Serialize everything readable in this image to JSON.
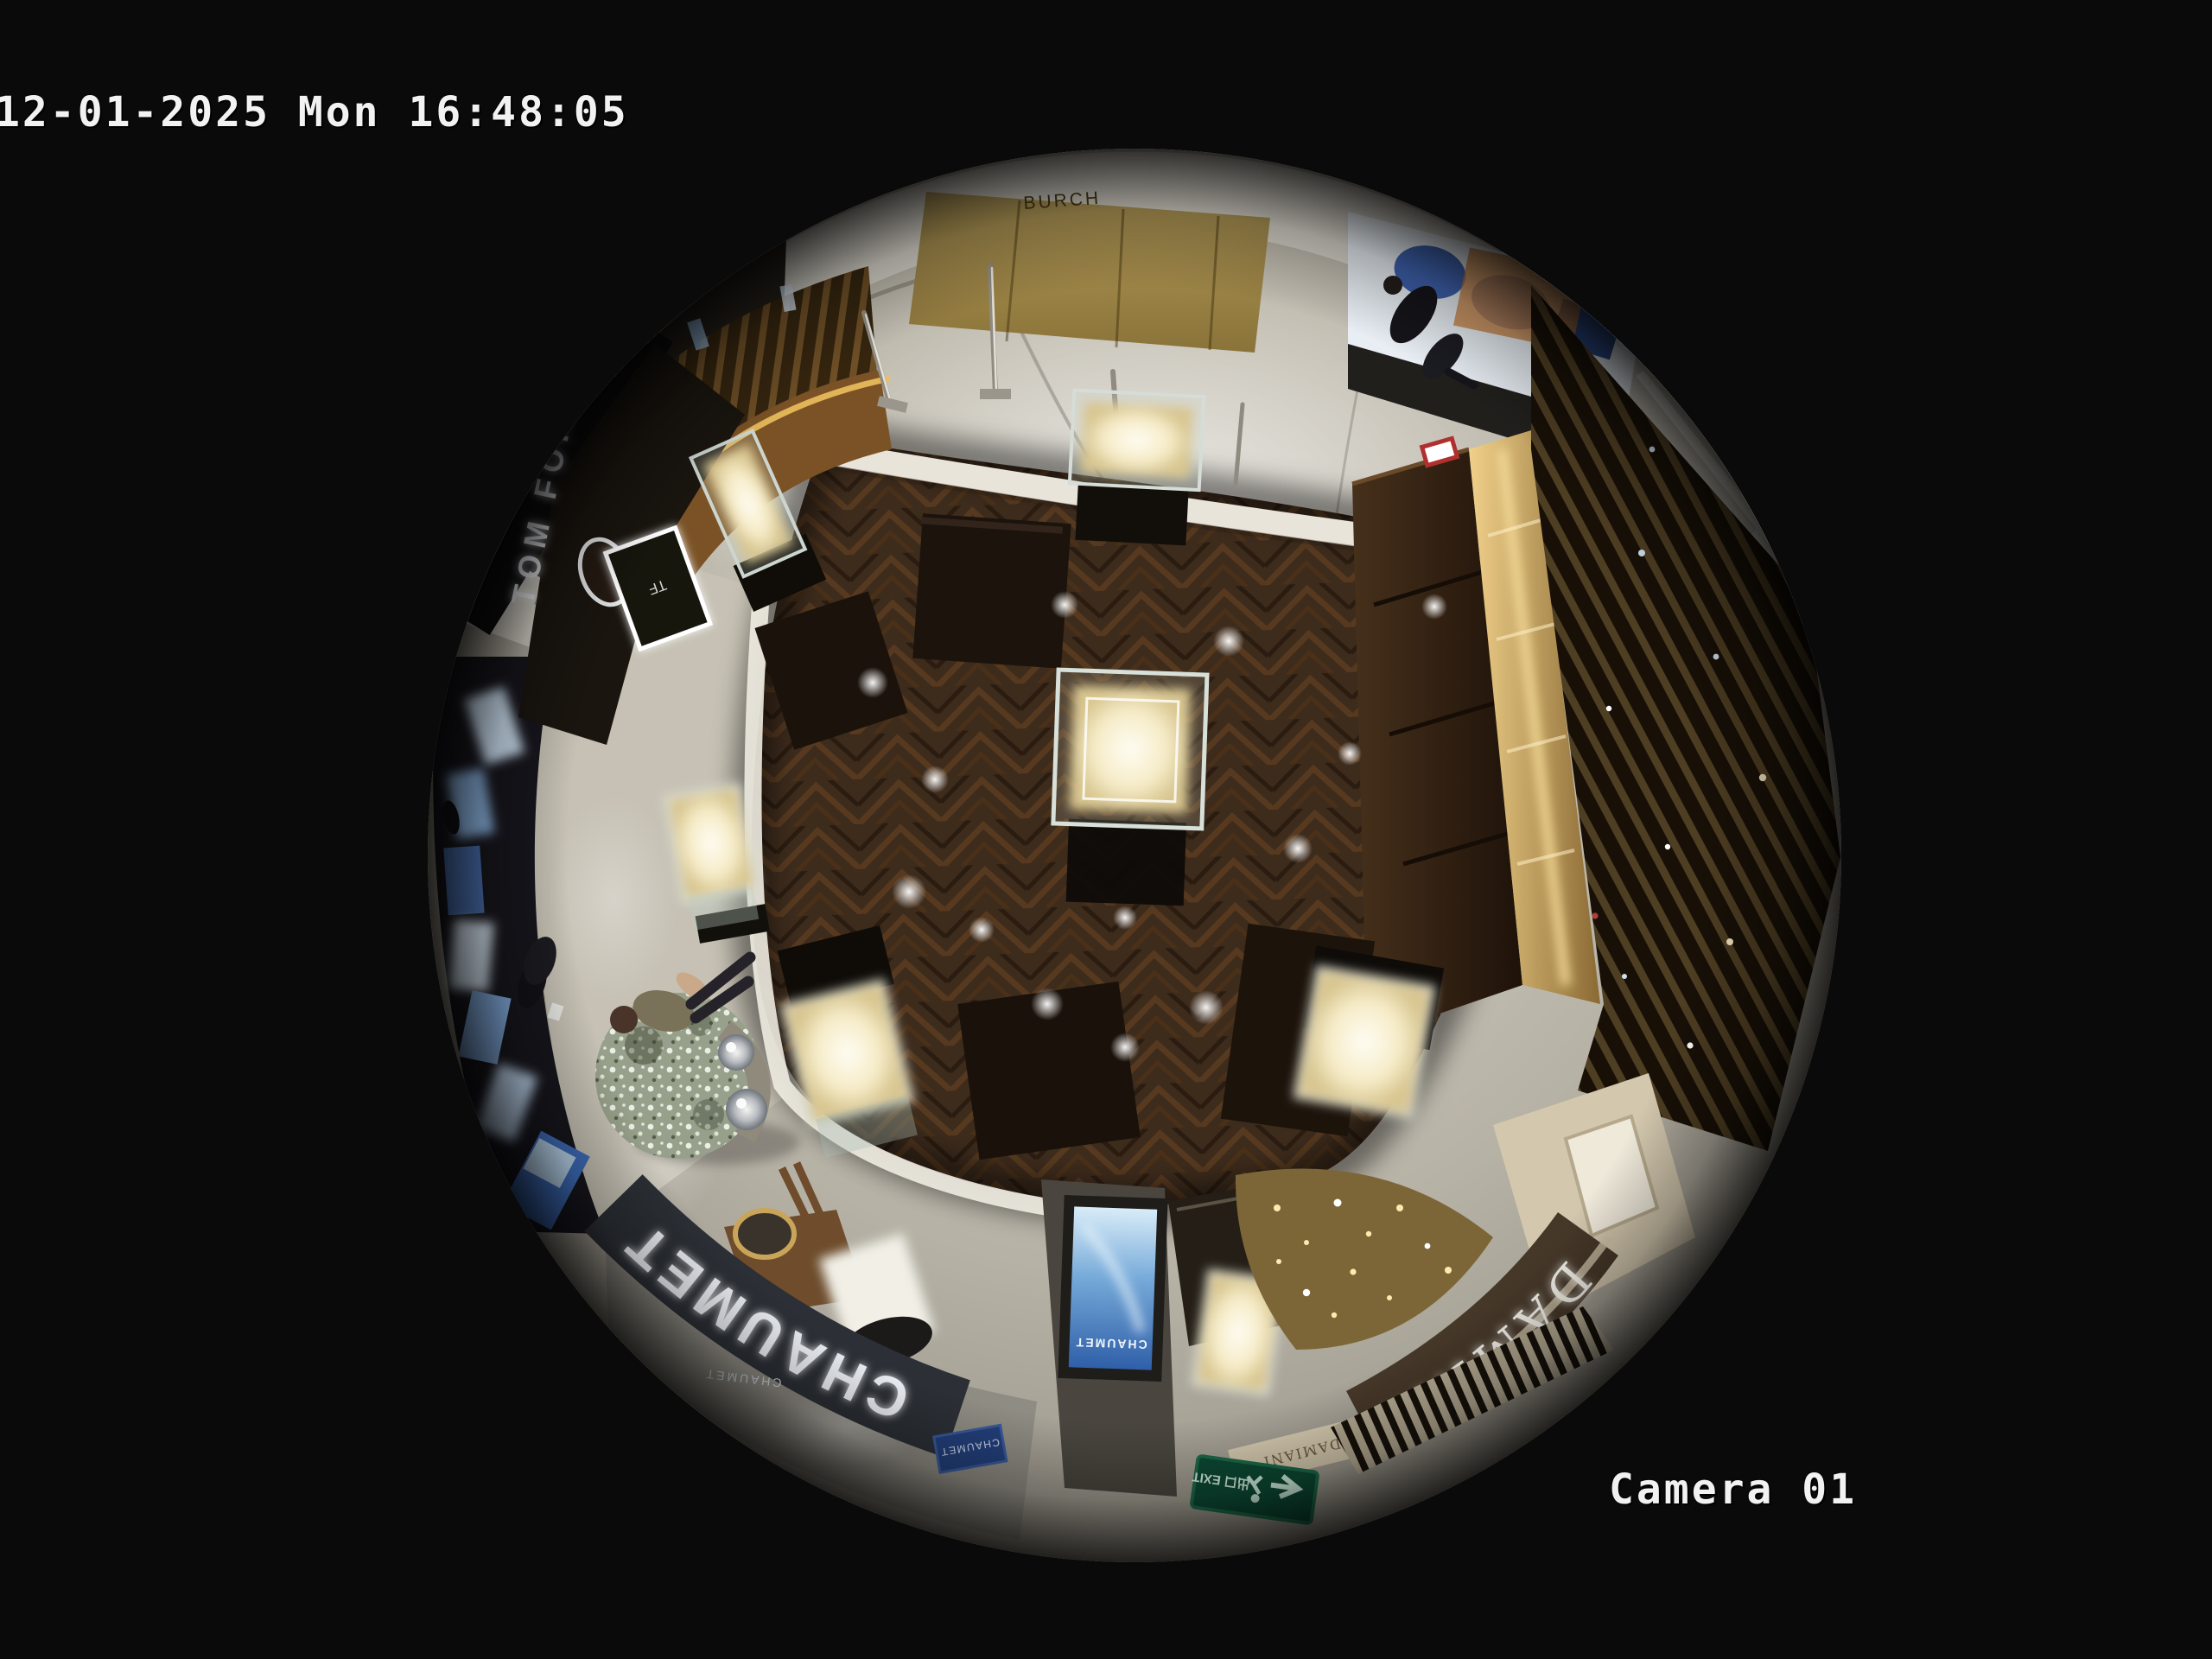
{
  "overlay": {
    "timestamp": "12-01-2025 Mon 16:48:05",
    "camera_label": "Camera 01"
  },
  "scene": {
    "signs": {
      "tom_ford": "TOM FORD",
      "tf_logo": "TF",
      "burch_wall": "BURCH",
      "chaumet_main": "CHAUMET",
      "chaumet_sub": "CHAUMET",
      "chaumet_screen": "CHAUMET",
      "chaumet_panel": "CHAUMET",
      "damiani_main": "DAMIANI",
      "damiani_sub": "DAMIANI",
      "exit_sign": "出口 EXIT"
    },
    "colors": {
      "frame_background": "#0a0a0a",
      "osd_text": "#f2f2f2",
      "wood_floor": "#3d2b1c",
      "marble_floor": "#b9b4a8",
      "exit_sign_green": "#0c4a34",
      "digital_screen_blue": "#3a6fb8",
      "brass_wall_gold": "#9d8a4f"
    }
  }
}
